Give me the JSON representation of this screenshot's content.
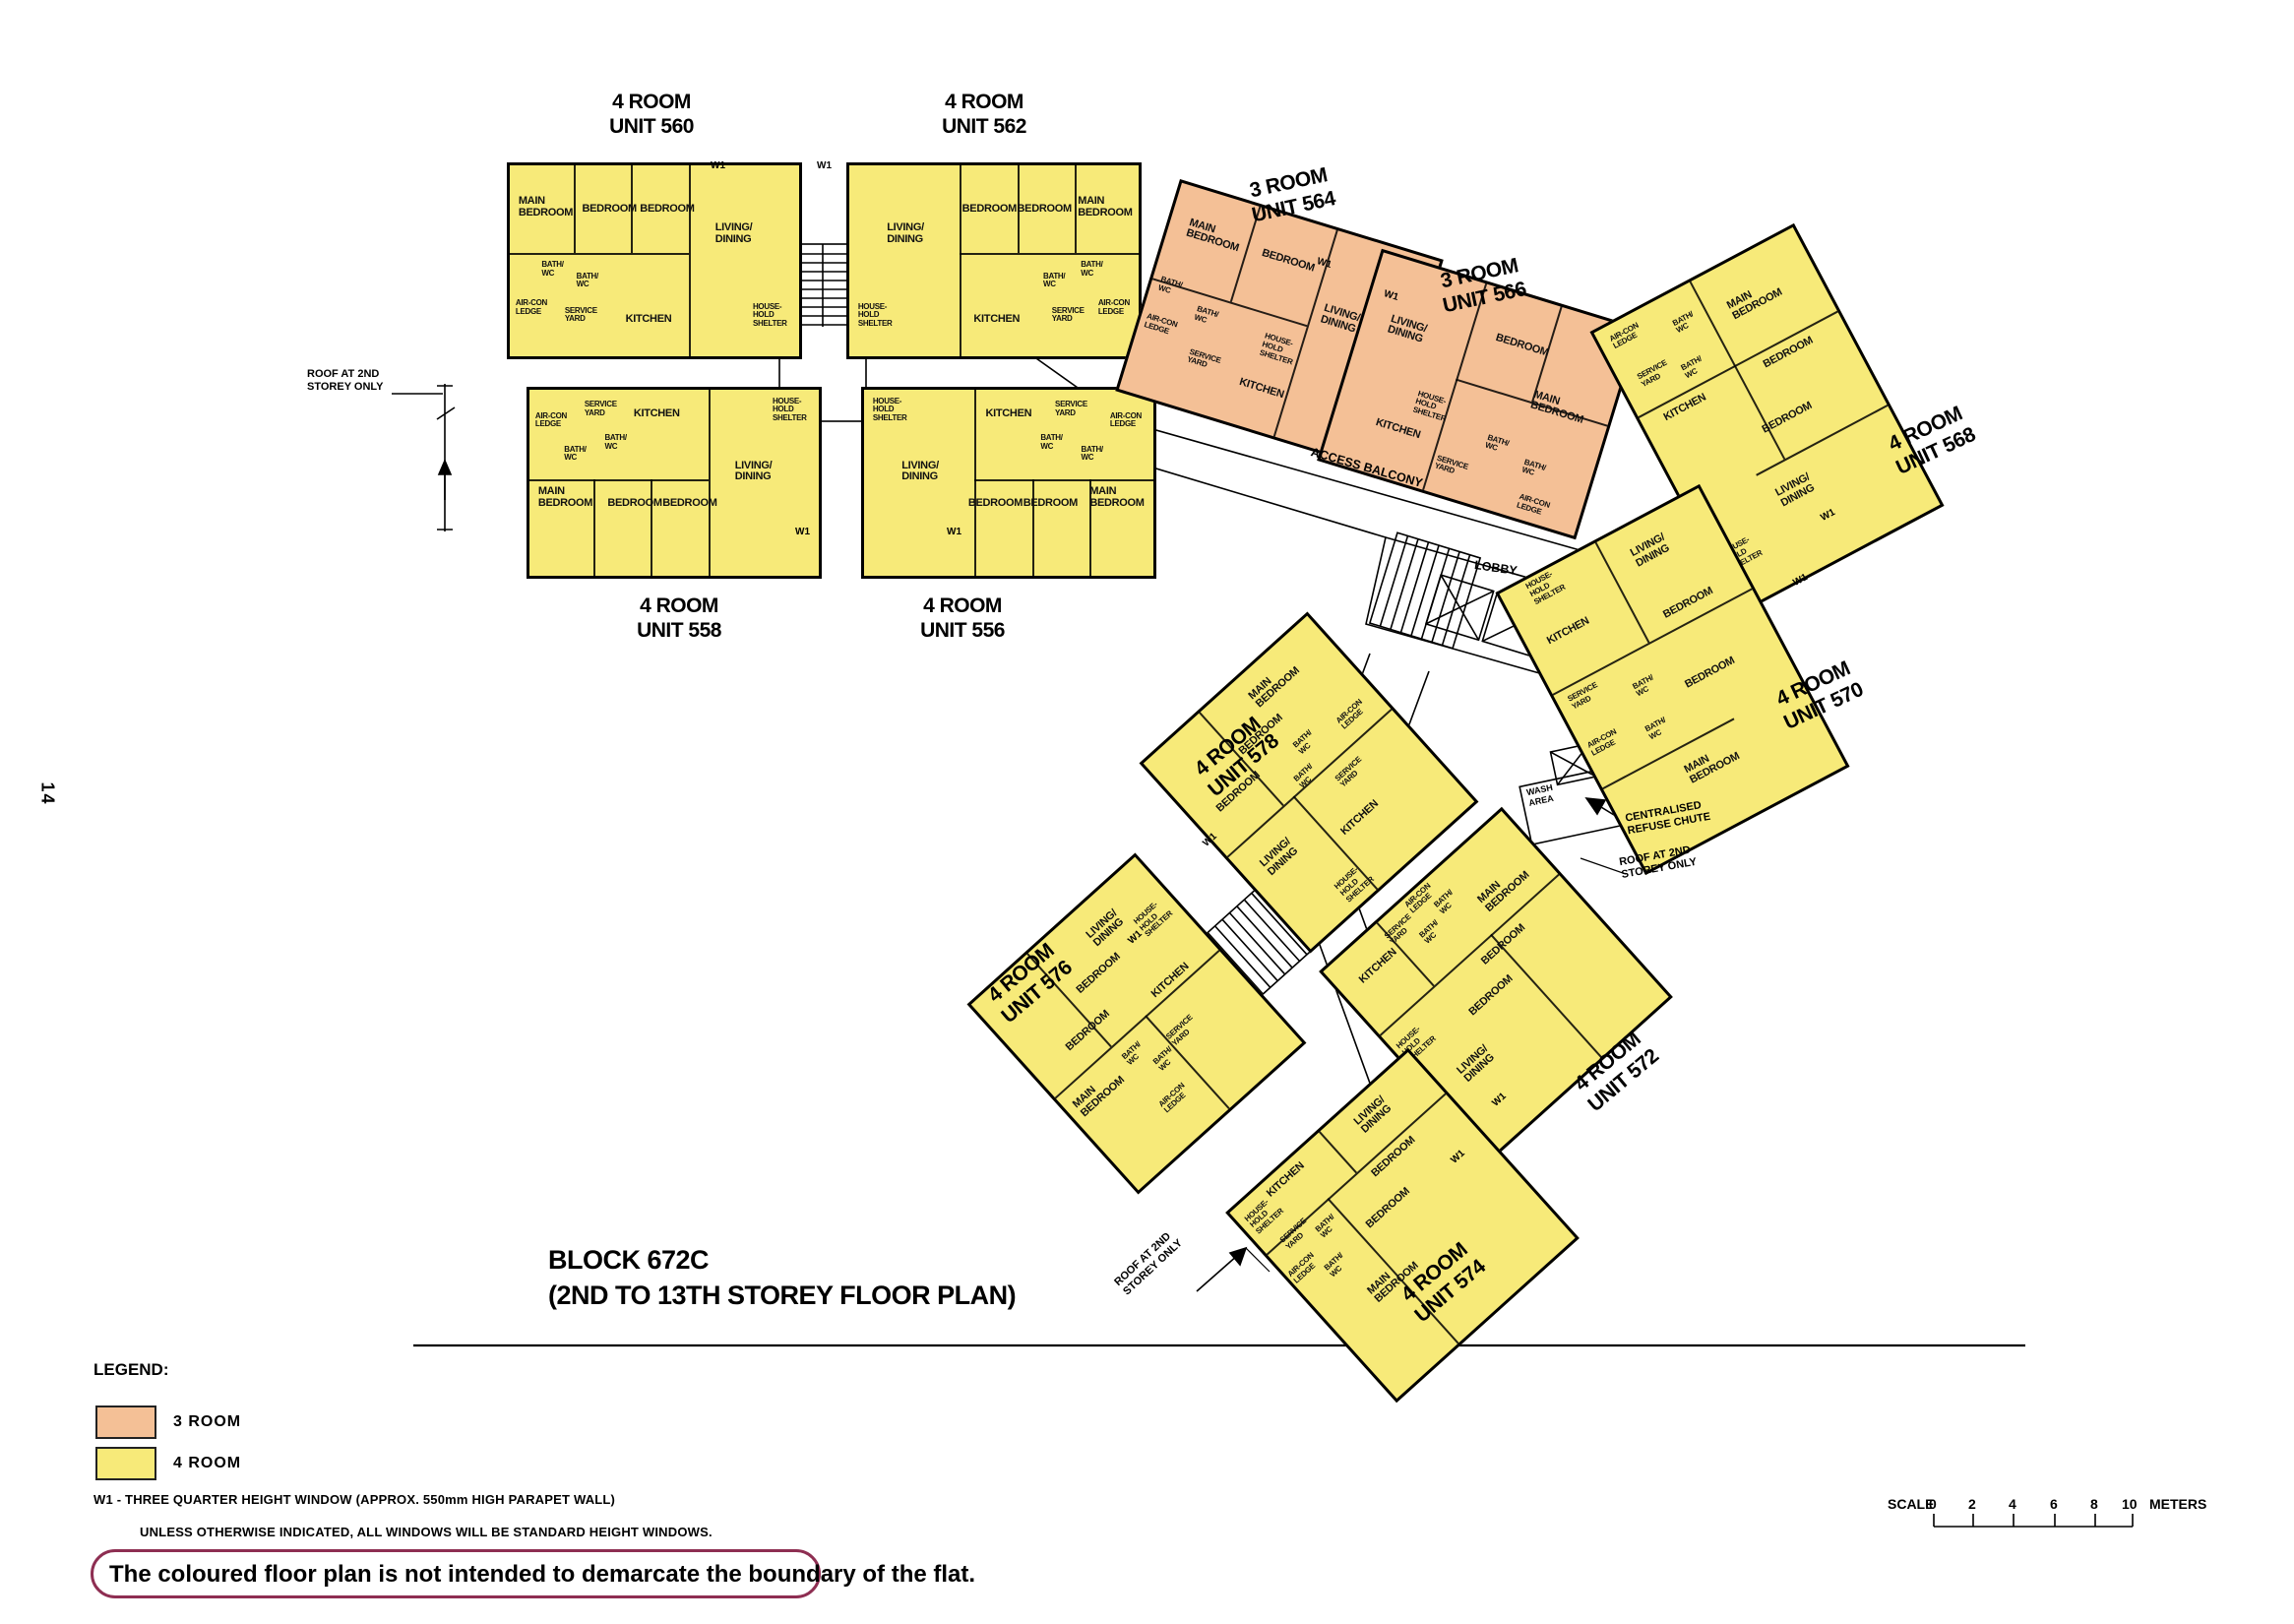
{
  "page": {
    "number": "14"
  },
  "title": {
    "block": "BLOCK 672C",
    "storey": "(2ND TO 13TH STOREY FLOOR PLAN)"
  },
  "colors": {
    "three_room": "#f4c096",
    "four_room": "#f7ea79",
    "note_box_border": "#8e2e52"
  },
  "legend": {
    "heading": "LEGEND:",
    "items": [
      {
        "label": "3 ROOM",
        "color": "#f4c096"
      },
      {
        "label": "4 ROOM",
        "color": "#f7ea79"
      }
    ],
    "w1_note": "W1 - THREE QUARTER HEIGHT WINDOW (APPROX. 550mm HIGH PARAPET WALL)",
    "window_note": "UNLESS OTHERWISE INDICATED, ALL WINDOWS WILL BE STANDARD HEIGHT WINDOWS.",
    "boxed_note": "The coloured floor plan is not intended to demarcate the boundary of the flat."
  },
  "scale_bar": {
    "label": "SCALE",
    "ticks": [
      "0",
      "2",
      "4",
      "6",
      "8",
      "10"
    ],
    "unit": "METERS"
  },
  "annotations": {
    "w1": "W1",
    "access_balcony": "ACCESS BALCONY",
    "lobby": "LOBBY",
    "wash_area": "WASH AREA",
    "refuse_chute": "CENTRALISED REFUSE CHUTE",
    "roof_2nd_storey": "ROOF AT 2ND STOREY ONLY"
  },
  "units": [
    {
      "type": "4 ROOM",
      "number": "UNIT 560",
      "rooms": [
        "MAIN BEDROOM",
        "BEDROOM",
        "BEDROOM",
        "LIVING/ DINING",
        "BATH/ WC",
        "BATH/ WC",
        "AIR-CON LEDGE",
        "SERVICE YARD",
        "KITCHEN",
        "HOUSE- HOLD SHELTER"
      ]
    },
    {
      "type": "4 ROOM",
      "number": "UNIT 562",
      "rooms": [
        "MAIN BEDROOM",
        "BEDROOM",
        "BEDROOM",
        "LIVING/ DINING",
        "BATH/ WC",
        "BATH/ WC",
        "AIR-CON LEDGE",
        "SERVICE YARD",
        "KITCHEN",
        "HOUSE- HOLD SHELTER"
      ]
    },
    {
      "type": "4 ROOM",
      "number": "UNIT 558",
      "rooms": [
        "MAIN BEDROOM",
        "BEDROOM",
        "BEDROOM",
        "LIVING/ DINING",
        "BATH/ WC",
        "BATH/ WC",
        "AIR-CON LEDGE",
        "SERVICE YARD",
        "KITCHEN",
        "HOUSE- HOLD SHELTER"
      ]
    },
    {
      "type": "4 ROOM",
      "number": "UNIT 556",
      "rooms": [
        "MAIN BEDROOM",
        "BEDROOM",
        "BEDROOM",
        "LIVING/ DINING",
        "BATH/ WC",
        "BATH/ WC",
        "AIR-CON LEDGE",
        "SERVICE YARD",
        "KITCHEN",
        "HOUSE- HOLD SHELTER"
      ]
    },
    {
      "type": "3 ROOM",
      "number": "UNIT 564",
      "rooms": [
        "MAIN BEDROOM",
        "BEDROOM",
        "LIVING/ DINING",
        "BATH/ WC",
        "BATH/ WC",
        "AIR-CON LEDGE",
        "SERVICE YARD",
        "KITCHEN",
        "HOUSE- HOLD SHELTER"
      ]
    },
    {
      "type": "3 ROOM",
      "number": "UNIT 566",
      "rooms": [
        "MAIN BEDROOM",
        "BEDROOM",
        "LIVING/ DINING",
        "BATH/ WC",
        "BATH/ WC",
        "AIR-CON LEDGE",
        "SERVICE YARD",
        "KITCHEN",
        "HOUSE- HOLD SHELTER"
      ]
    },
    {
      "type": "4 ROOM",
      "number": "UNIT 568",
      "rooms": [
        "MAIN BEDROOM",
        "BEDROOM",
        "BEDROOM",
        "LIVING/ DINING",
        "BATH/ WC",
        "BATH/ WC",
        "AIR-CON LEDGE",
        "SERVICE YARD",
        "KITCHEN",
        "HOUSE- HOLD SHELTER"
      ]
    },
    {
      "type": "4 ROOM",
      "number": "UNIT 570",
      "rooms": [
        "MAIN BEDROOM",
        "BEDROOM",
        "BEDROOM",
        "LIVING/ DINING",
        "BATH/ WC",
        "BATH/ WC",
        "AIR-CON LEDGE",
        "SERVICE YARD",
        "KITCHEN",
        "HOUSE- HOLD SHELTER"
      ]
    },
    {
      "type": "4 ROOM",
      "number": "UNIT 578",
      "rooms": [
        "MAIN BEDROOM",
        "BEDROOM",
        "BEDROOM",
        "LIVING/ DINING",
        "BATH/ WC",
        "BATH/ WC",
        "AIR-CON LEDGE",
        "SERVICE YARD",
        "KITCHEN",
        "HOUSE- HOLD SHELTER"
      ]
    },
    {
      "type": "4 ROOM",
      "number": "UNIT 576",
      "rooms": [
        "MAIN BEDROOM",
        "BEDROOM",
        "BEDROOM",
        "LIVING/ DINING",
        "BATH/ WC",
        "BATH/ WC",
        "AIR-CON LEDGE",
        "SERVICE YARD",
        "KITCHEN",
        "HOUSE- HOLD SHELTER"
      ]
    },
    {
      "type": "4 ROOM",
      "number": "UNIT 572",
      "rooms": [
        "MAIN BEDROOM",
        "BEDROOM",
        "BEDROOM",
        "LIVING/ DINING",
        "BATH/ WC",
        "BATH/ WC",
        "AIR-CON LEDGE",
        "SERVICE YARD",
        "KITCHEN",
        "HOUSE- HOLD SHELTER"
      ]
    },
    {
      "type": "4 ROOM",
      "number": "UNIT 574",
      "rooms": [
        "MAIN BEDROOM",
        "BEDROOM",
        "BEDROOM",
        "LIVING/ DINING",
        "BATH/ WC",
        "BATH/ WC",
        "AIR-CON LEDGE",
        "SERVICE YARD",
        "KITCHEN",
        "HOUSE- HOLD SHELTER"
      ]
    }
  ]
}
